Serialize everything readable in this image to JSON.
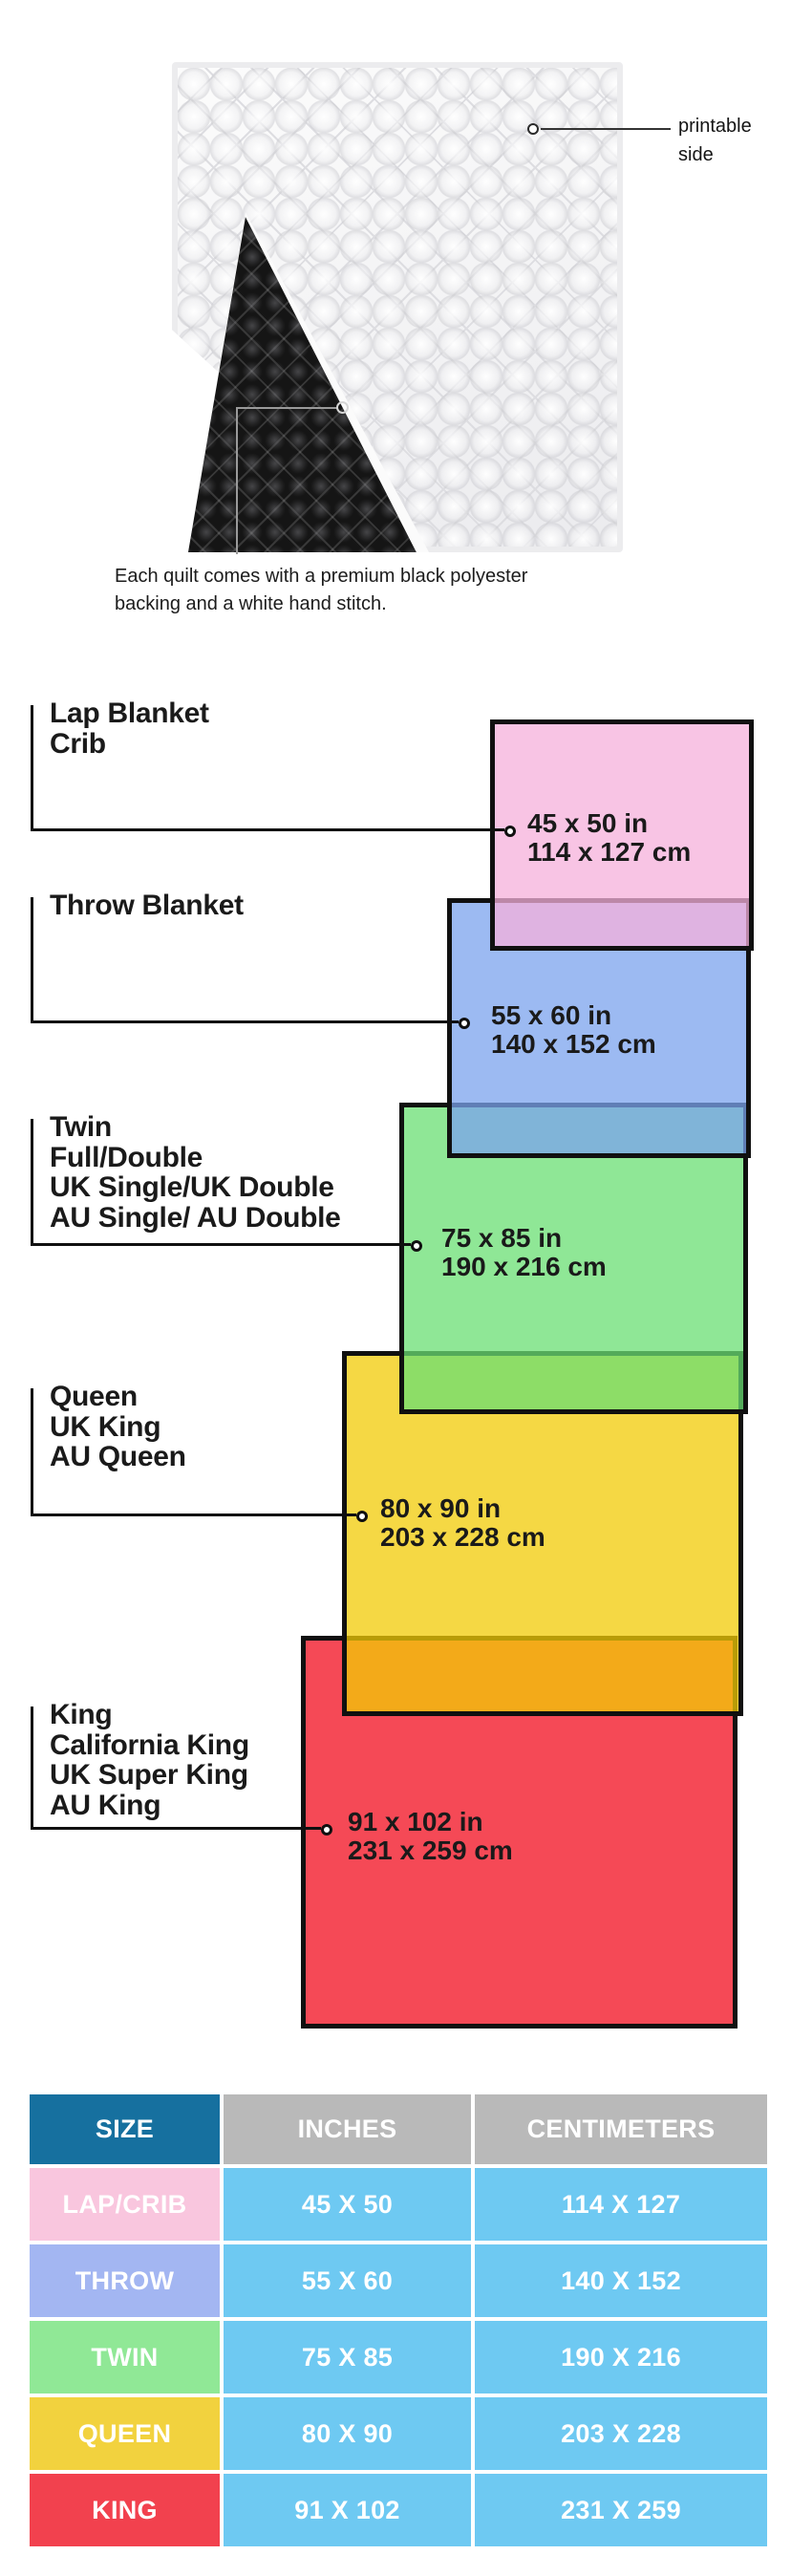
{
  "photo": {
    "printable_label_lines": [
      "printable",
      "side"
    ],
    "caption_lines": [
      "Each quilt comes with a premium black polyester",
      "backing and a white hand stitch."
    ],
    "front_color": "#f4f4f6",
    "backing_color": "#151515"
  },
  "diagram": {
    "sizes": [
      {
        "name": "lap-crib",
        "labels": [
          "Lap Blanket",
          "Crib"
        ],
        "inches": "45 x 50 in",
        "centimeters": "114 x 127 cm",
        "fill": "rgba(245,176,219,0.75)",
        "pure_color": "#f7c4e3"
      },
      {
        "name": "throw",
        "labels": [
          "Throw Blanket"
        ],
        "inches": "55 x 60 in",
        "centimeters": "140 x 152 cm",
        "fill": "rgba(123,163,237,0.75)",
        "pure_color": "#9cbaf2"
      },
      {
        "name": "twin",
        "labels": [
          "Twin",
          "Full/Double",
          "UK Single/UK Double",
          "AU Single/ AU Double"
        ],
        "inches": "75 x 85 in",
        "centimeters": "190 x 216 cm",
        "fill": "rgba(105,223,115,0.75)",
        "pure_color": "#8fe796"
      },
      {
        "name": "queen",
        "labels": [
          "Queen",
          "UK King",
          "AU Queen"
        ],
        "inches": "80 x 90 in",
        "centimeters": "203 x 228 cm",
        "fill": "rgba(241,203,5,0.75)",
        "pure_color": "#f5d844"
      },
      {
        "name": "king",
        "labels": [
          "King",
          "California King",
          "UK Super King",
          "AU King"
        ],
        "inches": "91 x 102 in",
        "centimeters": "231 x 259 cm",
        "fill": "rgba(241,12,29,0.75)",
        "pure_color": "#f54b56"
      }
    ]
  },
  "table": {
    "headers": [
      "SIZE",
      "INCHES",
      "CENTIMETERS"
    ],
    "header_size_bg": "#16709f",
    "header_metric_bg": "#b9b9b9",
    "data_cell_bg": "#6ec9f2",
    "text_color": "#ffffff",
    "rows": [
      {
        "label": "LAP/CRIB",
        "label_bg": "#f9c6de",
        "inches": "45 X 50",
        "centimeters": "114 X 127"
      },
      {
        "label": "THROW",
        "label_bg": "#a3b6f2",
        "inches": "55 X 60",
        "centimeters": "140 X 152"
      },
      {
        "label": "TWIN",
        "label_bg": "#90e896",
        "inches": "75 X 85",
        "centimeters": "190 X 216"
      },
      {
        "label": "QUEEN",
        "label_bg": "#f2d23e",
        "inches": "80 X 90",
        "centimeters": "203 X 228"
      },
      {
        "label": "KING",
        "label_bg": "#f2414e",
        "inches": "91 X 102",
        "centimeters": "231 X 259"
      }
    ]
  }
}
